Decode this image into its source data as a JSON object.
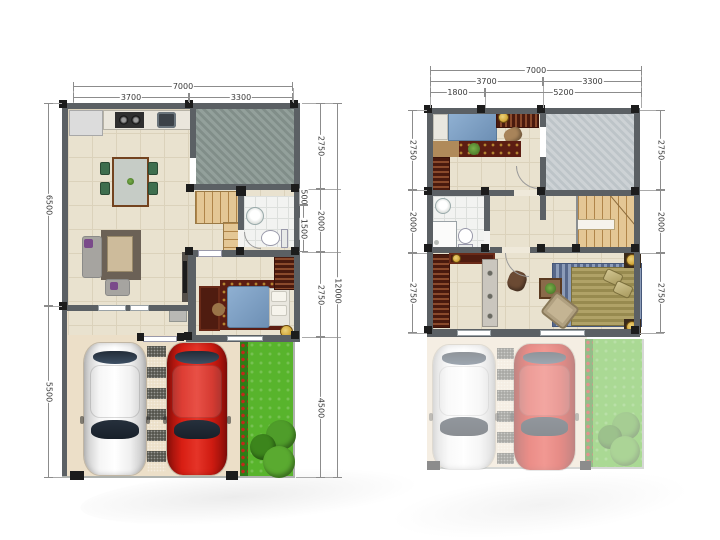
{
  "colors": {
    "wall": "#5b6064",
    "wall_block": "#1c1c1c",
    "floor": "#e9e2cf",
    "floor_line": "#dbd2bb",
    "carport_floor": "#ecdfc8",
    "patio_a": "#93a09b",
    "patio_b": "#818e89",
    "terrace_a": "#cdd2d5",
    "terrace_b": "#bdc4c8",
    "bath": "#f2f3f1",
    "bath_line": "#dcdfdc",
    "grass": "#58b42c",
    "grass_dark": "#2e7d16",
    "flower": "#c4271c",
    "car_white": "#f4f4f4",
    "car_red": "#d91d12",
    "glass": "#26303c",
    "stair": "#e4c795",
    "stair_line": "#b08549",
    "bed_blue": "#7b9cc2",
    "bed_tan": "#ab9d60",
    "mattress": "#e9e7df",
    "rug_red": "#5c1d12",
    "rug_blue": "#8c9cb8",
    "rug_blue_dark": "#57688a",
    "wood": "#4f1c10",
    "sofa": "#a6a4a0",
    "sofa_rug": "#6b6156",
    "table_tan": "#cdbb9b",
    "counter": "#eae6dc",
    "steel": "#3c4248",
    "gold": "#d4a93c",
    "chair_green": "#3e6e4e",
    "purple": "#7a4a8a",
    "dim_line": "#8c8c8c",
    "dim_text": "#3a3a3a"
  },
  "plan1": {
    "dims": {
      "top": {
        "total": "7000",
        "left": "3700",
        "right": "3300"
      },
      "left": {
        "upper": "6500",
        "lower": "5500"
      },
      "right": {
        "a1": "500",
        "a2": "1500",
        "b1": "2750",
        "b2": "2000",
        "b3": "2750",
        "b4": "4500",
        "total": "12000"
      }
    }
  },
  "plan2": {
    "dims": {
      "top": {
        "total": "7000",
        "mid_left": "3700",
        "mid_right": "3300",
        "inner_left": "1800",
        "inner_right": "5200"
      },
      "left": {
        "s1": "2750",
        "s2": "2000",
        "s3": "2750"
      },
      "right": {
        "s1": "2750",
        "s2": "2000",
        "s3": "2750"
      }
    }
  }
}
